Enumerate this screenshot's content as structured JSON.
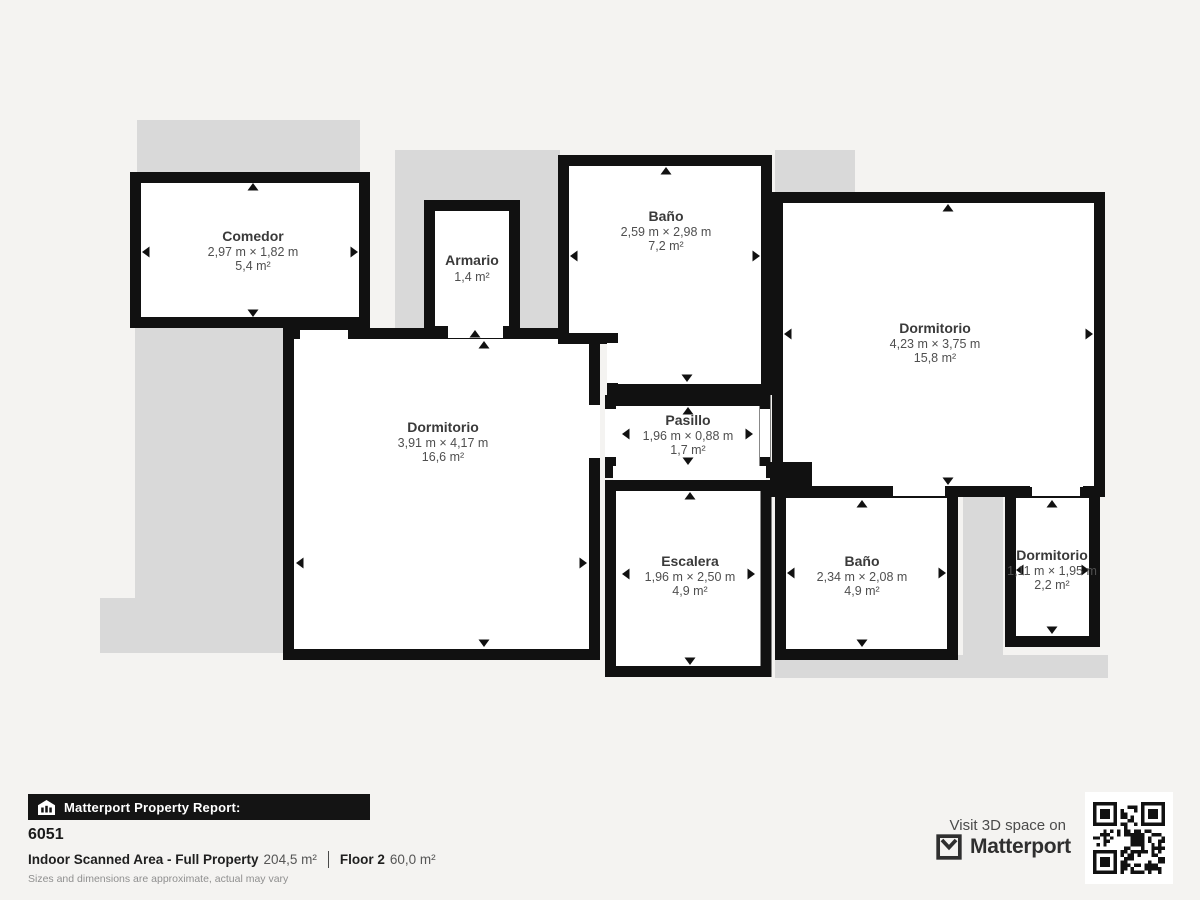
{
  "colors": {
    "background": "#f4f3f1",
    "wall": "#111111",
    "room_fill": "#ffffff",
    "underlay": "#d9d9d9",
    "banner_bg": "#141414"
  },
  "plan": {
    "rooms": [
      {
        "id": "comedor",
        "name": "Comedor",
        "dims": "2,97 m × 1,82 m",
        "area": "5,4 m²"
      },
      {
        "id": "armario",
        "name": "Armario",
        "dims": "",
        "area": "1,4 m²"
      },
      {
        "id": "bano-top",
        "name": "Baño",
        "dims": "2,59 m × 2,98 m",
        "area": "7,2 m²"
      },
      {
        "id": "dormitorio-right",
        "name": "Dormitorio",
        "dims": "4,23 m × 3,75 m",
        "area": "15,8 m²"
      },
      {
        "id": "dormitorio-left",
        "name": "Dormitorio",
        "dims": "3,91 m × 4,17 m",
        "area": "16,6 m²"
      },
      {
        "id": "pasillo",
        "name": "Pasillo",
        "dims": "1,96 m × 0,88 m",
        "area": "1,7 m²"
      },
      {
        "id": "escalera",
        "name": "Escalera",
        "dims": "1,96 m × 2,50 m",
        "area": "4,9 m²"
      },
      {
        "id": "bano-bottom",
        "name": "Baño",
        "dims": "2,34 m × 2,08 m",
        "area": "4,9 m²"
      },
      {
        "id": "dormitorio-small",
        "name": "Dormitorio",
        "dims": "1,11 m × 1,95 m",
        "area": "2,2 m²"
      }
    ]
  },
  "footer": {
    "report_label": "Matterport Property Report:",
    "property_id": "6051",
    "scanned_area_label": "Indoor Scanned Area - Full Property",
    "scanned_area_value": "204,5 m²",
    "floor_label": "Floor 2",
    "floor_value": "60,0 m²",
    "disclaimer": "Sizes and dimensions are approximate, actual may vary",
    "visit_label": "Visit 3D space on",
    "brand": "Matterport"
  }
}
